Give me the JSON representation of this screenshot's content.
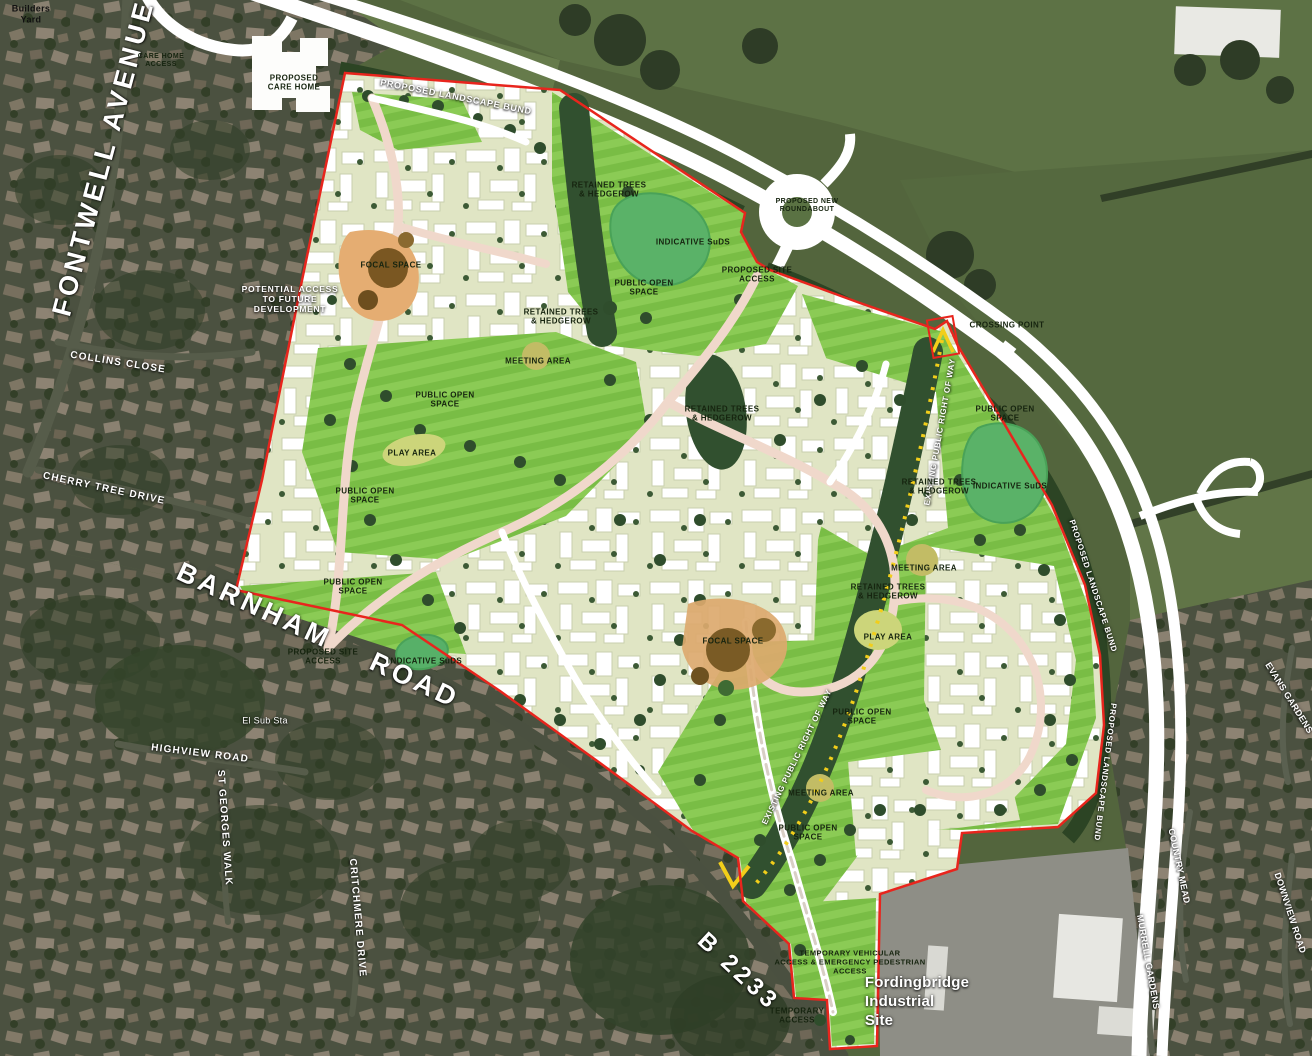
{
  "map": {
    "kind": "development-masterplan-over-aerial-photo",
    "colors": {
      "site_boundary_red": "#e8251d",
      "open_space_green": "#7cc047",
      "suds_pond_green": "#57b068",
      "housing_parcel_cream": "#e0e5c4",
      "retained_trees_dark": "#31502f",
      "right_of_way_yellow": "#f2ce1a",
      "internal_road_pink": "#f0d8cb",
      "focal_space_orange": "#e5ad72",
      "meeting_area_olive": "#c2bc65",
      "main_road_white": "#ffffff"
    }
  },
  "labels": [
    {
      "id": "builders-yard",
      "text": "Builders\nYard"
    },
    {
      "id": "fontwell-avenue",
      "text": "FONTWELL AVENUE"
    },
    {
      "id": "care-home-access",
      "text": "CARE HOME\nACCESS"
    },
    {
      "id": "proposed-care-home",
      "text": "PROPOSED\nCARE HOME"
    },
    {
      "id": "proposed-landscape-bund-top",
      "text": "PROPOSED LANDSCAPE BUND"
    },
    {
      "id": "proposed-new-roundabout",
      "text": "PROPOSED NEW\nROUNDABOUT"
    },
    {
      "id": "retained-trees-1",
      "text": "RETAINED TREES\n& HEDGEROW"
    },
    {
      "id": "indicative-suds-top",
      "text": "INDICATIVE SuDS"
    },
    {
      "id": "public-open-space-1",
      "text": "PUBLIC OPEN\nSPACE"
    },
    {
      "id": "proposed-site-access-ne",
      "text": "PROPOSED SITE\nACCESS"
    },
    {
      "id": "crossing-point",
      "text": "CROSSING POINT"
    },
    {
      "id": "potential-access",
      "text": "POTENTIAL ACCESS\nTO FUTURE\nDEVELOPMENT"
    },
    {
      "id": "focal-space-nw",
      "text": "FOCAL SPACE"
    },
    {
      "id": "retained-trees-2",
      "text": "RETAINED TREES\n& HEDGEROW"
    },
    {
      "id": "meeting-area-1",
      "text": "MEETING AREA"
    },
    {
      "id": "public-open-space-2",
      "text": "PUBLIC OPEN\nSPACE"
    },
    {
      "id": "retained-trees-3",
      "text": "RETAINED TREES\n& HEDGEROW"
    },
    {
      "id": "play-area-1",
      "text": "PLAY AREA"
    },
    {
      "id": "public-open-space-3",
      "text": "PUBLIC OPEN\nSPACE"
    },
    {
      "id": "existing-prow-1",
      "text": "EXISTING PUBLIC RIGHT OF WAY"
    },
    {
      "id": "public-open-space-4",
      "text": "PUBLIC OPEN\nSPACE"
    },
    {
      "id": "retained-trees-4",
      "text": "RETAINED TREES\n& HEDGEROW"
    },
    {
      "id": "indicative-suds-right",
      "text": "INDICATIVE SuDS"
    },
    {
      "id": "public-open-space-5",
      "text": "PUBLIC OPEN\nSPACE"
    },
    {
      "id": "meeting-area-2",
      "text": "MEETING AREA"
    },
    {
      "id": "retained-trees-5",
      "text": "RETAINED TREES\n& HEDGEROW"
    },
    {
      "id": "play-area-2",
      "text": "PLAY AREA"
    },
    {
      "id": "barnham-road",
      "text": "BARNHAM  ROAD"
    },
    {
      "id": "proposed-site-access-sw",
      "text": "PROPOSED SITE\nACCESS"
    },
    {
      "id": "indicative-suds-sw",
      "text": "INDICATIVE SuDS"
    },
    {
      "id": "focal-space-central",
      "text": "FOCAL SPACE"
    },
    {
      "id": "existing-prow-2",
      "text": "EXISTING PUBLIC RIGHT OF WAY"
    },
    {
      "id": "public-open-space-6",
      "text": "PUBLIC OPEN\nSPACE"
    },
    {
      "id": "meeting-area-3",
      "text": "MEETING AREA"
    },
    {
      "id": "public-open-space-7",
      "text": "PUBLIC OPEN\nSPACE"
    },
    {
      "id": "proposed-landscape-bund-right-1",
      "text": "PROPOSED LANDSCAPE BUND"
    },
    {
      "id": "proposed-landscape-bund-right-2",
      "text": "PROPOSED LANDSCAPE BUND"
    },
    {
      "id": "collins-close",
      "text": "COLLINS CLOSE"
    },
    {
      "id": "cherry-tree-drive",
      "text": "CHERRY TREE DRIVE"
    },
    {
      "id": "el-sub-sta",
      "text": "El Sub Sta"
    },
    {
      "id": "highview-road",
      "text": "HIGHVIEW ROAD"
    },
    {
      "id": "st-georges-walk",
      "text": "ST GEORGES WALK"
    },
    {
      "id": "critchmere-drive",
      "text": "CRITCHMERE DRIVE"
    },
    {
      "id": "b-2233",
      "text": "B 2233"
    },
    {
      "id": "temporary-vehicular-access",
      "text": "TEMPORARY VEHICULAR\nACCESS & EMERGENCY PEDESTRIAN\nACCESS"
    },
    {
      "id": "fordingbridge-industrial-site",
      "text": "Fordingbridge\nIndustrial\nSite"
    },
    {
      "id": "temporary-access",
      "text": "TEMPORARY\nACCESS"
    },
    {
      "id": "country-mead",
      "text": "COUNTRY MEAD"
    },
    {
      "id": "downview-road",
      "text": "DOWNVIEW ROAD"
    },
    {
      "id": "murrell-gardens",
      "text": "MURRELL GARDENS"
    },
    {
      "id": "evans-gardens",
      "text": "EVANS GARDENS"
    }
  ]
}
